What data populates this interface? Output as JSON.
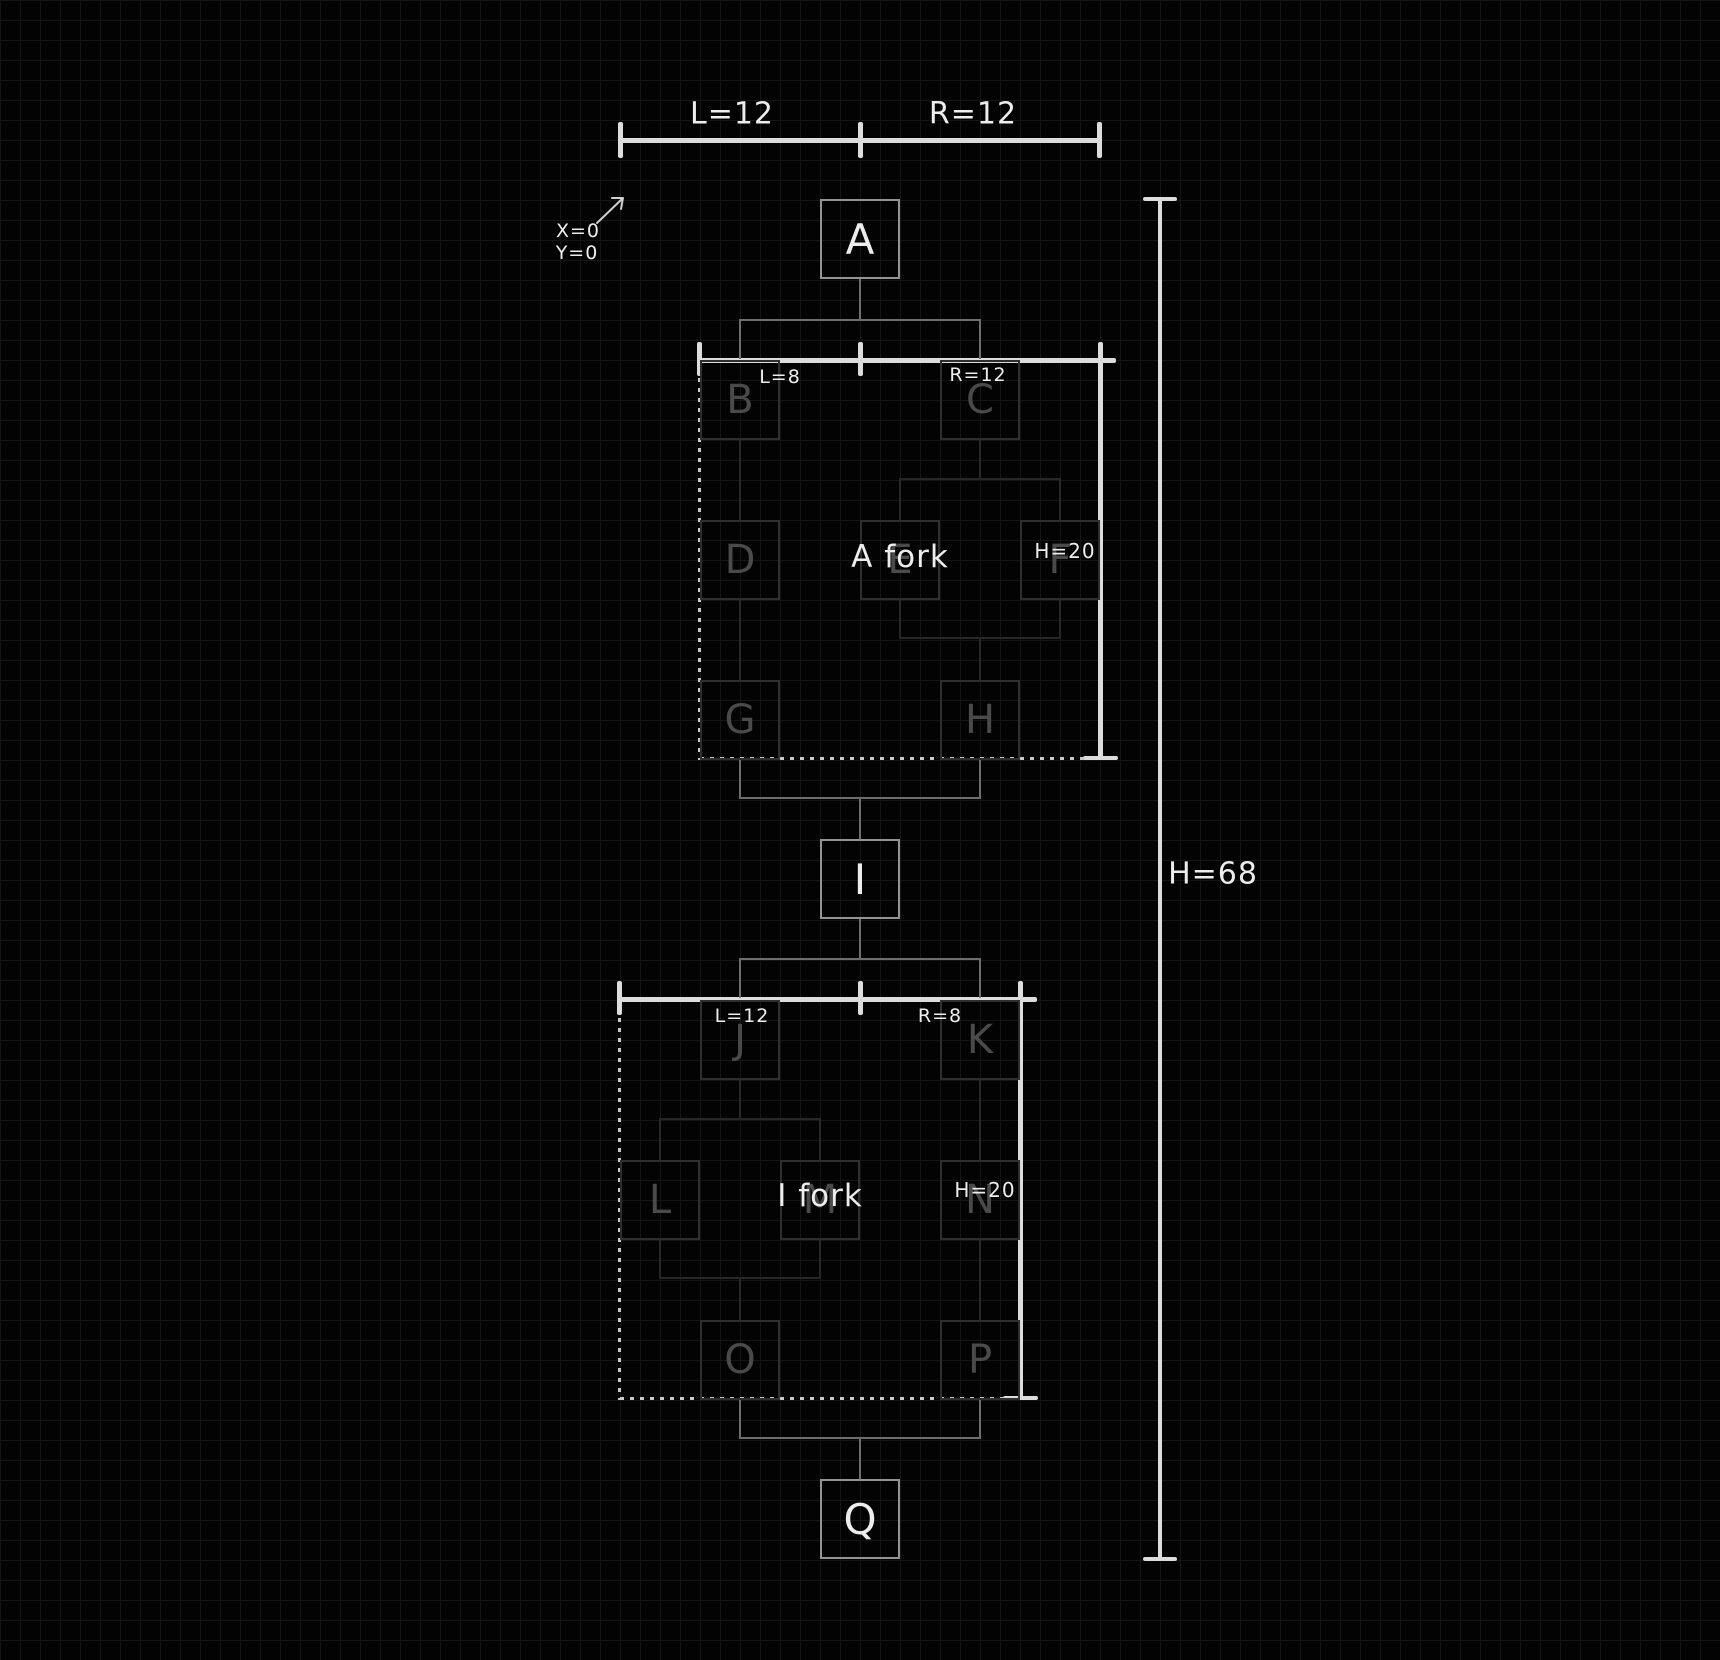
{
  "canvas": {
    "width": 1720,
    "height": 1660,
    "background": "#030303",
    "grid_size": 20,
    "grid_color": "#151515"
  },
  "palette": {
    "ruler": "#dcdcdc",
    "label_text": "#ededed",
    "node_border": "#939393",
    "connector": "#6e6e6e",
    "faded_border": "#2f2f2f",
    "faded_text": "#4a4a4a",
    "faded_connector": "#272727",
    "dotted_edge": "#c9c9c9"
  },
  "origin": {
    "x_label": "X=0",
    "y_label": "Y=0"
  },
  "top_ruler": {
    "left_label": "L=12",
    "right_label": "R=12"
  },
  "height_ruler": {
    "label": "H=68"
  },
  "fork_a": {
    "title": "A fork",
    "left_label": "L=8",
    "right_label": "R=12",
    "height_label": "H=20"
  },
  "fork_i": {
    "title": "I fork",
    "left_label": "L=12",
    "right_label": "R=8",
    "height_label": "H=20"
  },
  "labels": [
    {
      "name": "top-ruler-left-label",
      "text": "L=12",
      "cx": 732,
      "cy": 114,
      "fs": 30
    },
    {
      "name": "top-ruler-right-label",
      "text": "R=12",
      "cx": 973,
      "cy": 114,
      "fs": 30
    },
    {
      "name": "origin-x-label",
      "text": "X=0",
      "cx": 578,
      "cy": 231,
      "fs": 19
    },
    {
      "name": "origin-y-label",
      "text": "Y=0",
      "cx": 577,
      "cy": 253,
      "fs": 19
    },
    {
      "name": "fork-a-left-label",
      "text": "L=8",
      "cx": 780,
      "cy": 377,
      "fs": 19
    },
    {
      "name": "fork-a-right-label",
      "text": "R=12",
      "cx": 978,
      "cy": 375,
      "fs": 19
    },
    {
      "name": "fork-a-height-label",
      "text": "H=20",
      "cx": 1065,
      "cy": 551,
      "fs": 20
    },
    {
      "name": "fork-a-title",
      "text": "A fork",
      "cx": 900,
      "cy": 557,
      "fs": 31
    },
    {
      "name": "fork-i-left-label",
      "text": "L=12",
      "cx": 742,
      "cy": 1016,
      "fs": 19
    },
    {
      "name": "fork-i-right-label",
      "text": "R=8",
      "cx": 940,
      "cy": 1016,
      "fs": 19
    },
    {
      "name": "fork-i-height-label",
      "text": "H=20",
      "cx": 985,
      "cy": 1190,
      "fs": 20
    },
    {
      "name": "fork-i-title",
      "text": "I fork",
      "cx": 820,
      "cy": 1196,
      "fs": 31
    },
    {
      "name": "height-ruler-label",
      "text": "H=68",
      "cx": 1213,
      "cy": 874,
      "fs": 30
    }
  ],
  "geometry": {
    "main_boxes": [
      {
        "name": "node-a",
        "letter": "A",
        "x": 820,
        "y": 199
      },
      {
        "name": "node-i",
        "letter": "I",
        "x": 820,
        "y": 839
      },
      {
        "name": "node-q",
        "letter": "Q",
        "x": 820,
        "y": 1479
      }
    ],
    "faded_boxes": [
      {
        "name": "fork-a-node-b",
        "letter": "B",
        "x": 700,
        "y": 360
      },
      {
        "name": "fork-a-node-c",
        "letter": "C",
        "x": 940,
        "y": 360
      },
      {
        "name": "fork-a-node-d",
        "letter": "D",
        "x": 700,
        "y": 520
      },
      {
        "name": "fork-a-node-e",
        "letter": "E",
        "x": 860,
        "y": 520
      },
      {
        "name": "fork-a-node-f",
        "letter": "F",
        "x": 1020,
        "y": 520
      },
      {
        "name": "fork-a-node-g",
        "letter": "G",
        "x": 700,
        "y": 680
      },
      {
        "name": "fork-a-node-h",
        "letter": "H",
        "x": 940,
        "y": 680
      },
      {
        "name": "fork-i-node-j",
        "letter": "J",
        "x": 700,
        "y": 1000
      },
      {
        "name": "fork-i-node-k",
        "letter": "K",
        "x": 940,
        "y": 1000
      },
      {
        "name": "fork-i-node-l",
        "letter": "L",
        "x": 620,
        "y": 1160
      },
      {
        "name": "fork-i-node-m",
        "letter": "M",
        "x": 780,
        "y": 1160
      },
      {
        "name": "fork-i-node-n",
        "letter": "N",
        "x": 940,
        "y": 1160
      },
      {
        "name": "fork-i-node-o",
        "letter": "O",
        "x": 700,
        "y": 1320
      },
      {
        "name": "fork-i-node-p",
        "letter": "P",
        "x": 940,
        "y": 1320
      }
    ],
    "bright_segments": [
      {
        "name": "top-ruler-line",
        "x": 618,
        "y": 138,
        "w": 484,
        "h": 5
      },
      {
        "name": "top-ruler-tick-left",
        "x": 618,
        "y": 122,
        "w": 5,
        "h": 36
      },
      {
        "name": "top-ruler-tick-center",
        "x": 858,
        "y": 122,
        "w": 5,
        "h": 36
      },
      {
        "name": "top-ruler-tick-right",
        "x": 1097,
        "y": 122,
        "w": 5,
        "h": 36
      },
      {
        "name": "height-ruler-line",
        "x": 1158,
        "y": 199,
        "w": 4,
        "h": 1361
      },
      {
        "name": "height-ruler-cap-top",
        "x": 1143,
        "y": 197,
        "w": 34,
        "h": 4
      },
      {
        "name": "height-ruler-cap-bottom",
        "x": 1143,
        "y": 1557,
        "w": 34,
        "h": 4
      },
      {
        "name": "fork-a-ruler-line",
        "x": 698,
        "y": 358,
        "w": 418,
        "h": 5
      },
      {
        "name": "fork-a-ruler-tick-left",
        "x": 697,
        "y": 342,
        "w": 5,
        "h": 34
      },
      {
        "name": "fork-a-ruler-tick-center",
        "x": 858,
        "y": 342,
        "w": 5,
        "h": 34
      },
      {
        "name": "fork-a-height-line",
        "x": 1098,
        "y": 342,
        "w": 5,
        "h": 418
      },
      {
        "name": "fork-a-height-cap",
        "x": 1083,
        "y": 756,
        "w": 35,
        "h": 4
      },
      {
        "name": "fork-i-ruler-line",
        "x": 618,
        "y": 997,
        "w": 419,
        "h": 5
      },
      {
        "name": "fork-i-ruler-tick-left",
        "x": 617,
        "y": 981,
        "w": 5,
        "h": 34
      },
      {
        "name": "fork-i-ruler-tick-center",
        "x": 858,
        "y": 981,
        "w": 5,
        "h": 34
      },
      {
        "name": "fork-i-height-line",
        "x": 1018,
        "y": 981,
        "w": 5,
        "h": 418
      },
      {
        "name": "fork-i-height-cap",
        "x": 1003,
        "y": 1396,
        "w": 35,
        "h": 4
      }
    ],
    "dotted_segments": [
      {
        "name": "fork-a-left-edge",
        "x": 698,
        "y": 378,
        "w": 3,
        "h": 382
      },
      {
        "name": "fork-a-bottom-edge",
        "x": 700,
        "y": 757,
        "w": 386,
        "h": 3
      },
      {
        "name": "fork-i-left-edge",
        "x": 618,
        "y": 1018,
        "w": 3,
        "h": 382
      },
      {
        "name": "fork-i-bottom-edge",
        "x": 620,
        "y": 1397,
        "w": 386,
        "h": 3
      }
    ],
    "connector_segments": [
      {
        "name": "a-stem",
        "x": 859,
        "y": 279,
        "w": 2,
        "h": 42
      },
      {
        "name": "a-fork-bracket",
        "x": 739,
        "y": 319,
        "w": 242,
        "h": 2
      },
      {
        "name": "a-fork-drop-left",
        "x": 739,
        "y": 319,
        "w": 2,
        "h": 40
      },
      {
        "name": "a-fork-drop-right",
        "x": 979,
        "y": 319,
        "w": 2,
        "h": 40
      },
      {
        "name": "a-fork-out-left",
        "x": 739,
        "y": 760,
        "w": 2,
        "h": 39
      },
      {
        "name": "a-fork-out-right",
        "x": 979,
        "y": 760,
        "w": 2,
        "h": 39
      },
      {
        "name": "a-fork-merge-bar",
        "x": 739,
        "y": 797,
        "w": 242,
        "h": 2
      },
      {
        "name": "i-stem-top",
        "x": 859,
        "y": 797,
        "w": 2,
        "h": 43
      },
      {
        "name": "i-stem-bottom",
        "x": 859,
        "y": 919,
        "w": 2,
        "h": 41
      },
      {
        "name": "i-fork-bracket",
        "x": 739,
        "y": 958,
        "w": 242,
        "h": 2
      },
      {
        "name": "i-fork-drop-left",
        "x": 739,
        "y": 958,
        "w": 2,
        "h": 40
      },
      {
        "name": "i-fork-drop-right",
        "x": 979,
        "y": 958,
        "w": 2,
        "h": 40
      },
      {
        "name": "i-fork-out-left",
        "x": 739,
        "y": 1400,
        "w": 2,
        "h": 39
      },
      {
        "name": "i-fork-out-right",
        "x": 979,
        "y": 1400,
        "w": 2,
        "h": 39
      },
      {
        "name": "i-fork-merge-bar",
        "x": 739,
        "y": 1437,
        "w": 242,
        "h": 2
      },
      {
        "name": "q-stem",
        "x": 859,
        "y": 1437,
        "w": 2,
        "h": 43
      }
    ],
    "faded_segments": [
      {
        "name": "b-to-d",
        "x": 739,
        "y": 440,
        "w": 2,
        "h": 80
      },
      {
        "name": "c-stem",
        "x": 979,
        "y": 440,
        "w": 2,
        "h": 39
      },
      {
        "name": "c-fork-bracket",
        "x": 899,
        "y": 478,
        "w": 162,
        "h": 2
      },
      {
        "name": "c-drop-e",
        "x": 899,
        "y": 478,
        "w": 2,
        "h": 42
      },
      {
        "name": "c-drop-f",
        "x": 1059,
        "y": 478,
        "w": 2,
        "h": 42
      },
      {
        "name": "d-to-g",
        "x": 739,
        "y": 600,
        "w": 2,
        "h": 80
      },
      {
        "name": "e-out",
        "x": 899,
        "y": 600,
        "w": 2,
        "h": 39
      },
      {
        "name": "f-out",
        "x": 1059,
        "y": 600,
        "w": 2,
        "h": 39
      },
      {
        "name": "ef-merge-bar",
        "x": 899,
        "y": 637,
        "w": 162,
        "h": 2
      },
      {
        "name": "merge-to-h",
        "x": 979,
        "y": 637,
        "w": 2,
        "h": 43
      },
      {
        "name": "j-stem",
        "x": 739,
        "y": 1080,
        "w": 2,
        "h": 40
      },
      {
        "name": "j-fork-bracket",
        "x": 659,
        "y": 1118,
        "w": 162,
        "h": 2
      },
      {
        "name": "j-drop-l",
        "x": 659,
        "y": 1118,
        "w": 2,
        "h": 42
      },
      {
        "name": "j-drop-m",
        "x": 819,
        "y": 1118,
        "w": 2,
        "h": 42
      },
      {
        "name": "k-to-n",
        "x": 979,
        "y": 1080,
        "w": 2,
        "h": 80
      },
      {
        "name": "l-out",
        "x": 659,
        "y": 1240,
        "w": 2,
        "h": 39
      },
      {
        "name": "m-out",
        "x": 819,
        "y": 1240,
        "w": 2,
        "h": 39
      },
      {
        "name": "lm-merge-bar",
        "x": 659,
        "y": 1277,
        "w": 162,
        "h": 2
      },
      {
        "name": "merge-to-o",
        "x": 739,
        "y": 1277,
        "w": 2,
        "h": 43
      },
      {
        "name": "n-to-p",
        "x": 979,
        "y": 1240,
        "w": 2,
        "h": 80
      }
    ]
  }
}
